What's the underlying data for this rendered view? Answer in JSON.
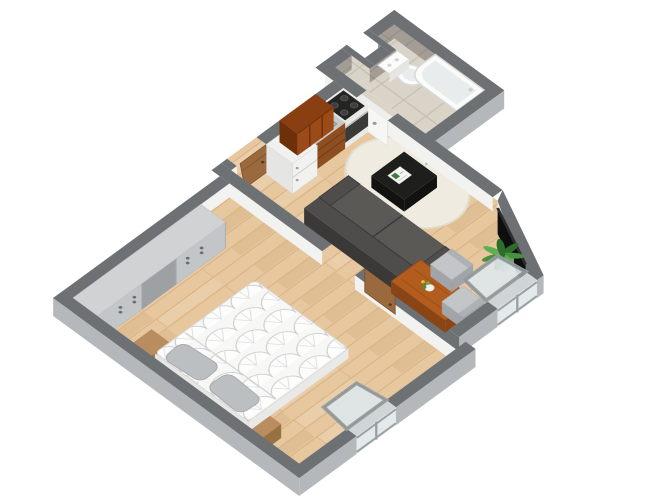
{
  "scene": {
    "description": "3D isometric floor plan render of a one-bedroom apartment, rotated diamond orientation on white background",
    "background": "#ffffff",
    "rooms": [
      {
        "name": "bathroom",
        "floor": "beige-tile",
        "walls": "grey-tile",
        "furniture": [
          "toilet",
          "corner-bathtub"
        ],
        "doors": [
          "bathroom-door-white"
        ]
      },
      {
        "name": "kitchen-living-room",
        "floor": "oak-parquet",
        "furniture": [
          "fridge",
          "kitchen-counter-sink",
          "stove",
          "upper-cabinets",
          "sofa",
          "tv",
          "oval-rug",
          "coffee-table",
          "dining-table",
          "dining-chairs",
          "potted-plant",
          "tilted-open-window"
        ],
        "doors": [
          "entry-door-wood",
          "bathroom-door-white",
          "bedroom-door-wood"
        ]
      },
      {
        "name": "bedroom",
        "floor": "oak-parquet",
        "furniture": [
          "double-bed-patterned-duvet",
          "pillows",
          "nightstands",
          "wardrobe",
          "tilted-open-window"
        ],
        "doors": [
          "bedroom-door-wood"
        ]
      }
    ],
    "palette": {
      "wallTop": "#6e7174",
      "wallExt": "#b5b8ba",
      "wallInt": "#f2f2f0",
      "tileWall": "#a49d96",
      "tileWallLine": "#958e87",
      "floorWood": "#e7c79e",
      "floorLine": "#c89a66",
      "floorTile": "#dad4c8",
      "floorTileLine": "#c7c0b3",
      "rug": "#f0ebe0",
      "rugEdge": "#e2dccd",
      "sofa": "#4e4d4b",
      "sofaSeat": "#5a5956",
      "sofaDark": "#3a3937",
      "coffeeTable": "#1e1e1c",
      "coffeeTableDark": "#121210",
      "tv": "#0e0e0e",
      "tvEdge": "#2e2e2e",
      "diningTable": "#b25c1e",
      "diningTableDark": "#8a4517",
      "chair": "#c3c6c8",
      "chairDark": "#a2a5a7",
      "upperCab": "#8a3f12",
      "upperCabFace": "#9c4b18",
      "upperCabDark": "#6e3009",
      "counter": "#c9c9c7",
      "cabinetFace": "#8f4e22",
      "cabinetDark": "#733c14",
      "stoveTop": "#242422",
      "stoveRim": "#e9e9e7",
      "burner": "#3f3f3d",
      "appliance": "#f1f1ef",
      "applianceFace": "#e5e5e3",
      "applianceLine": "#cfcfcd",
      "sink": "#aeb2b4",
      "sinkInner": "#989c9e",
      "fixture": "#fbfbf9",
      "fixtureShade": "#e9eced",
      "fixtureLine": "#d7dbdc",
      "doorWood": "#9a6a3e",
      "doorWoodDark": "#7e5430",
      "doorWhite": "#f6f6f4",
      "frame": "#9aa0a2",
      "glass": "#dfe7ea",
      "glassWall": "#e4eaec",
      "duvet": "#f7f7f5",
      "duvetLine": "#c9cccf",
      "pillow": "#bcbfc1",
      "pillowLine": "#a8abad",
      "nightstand": "#b98d5f",
      "nightstandDark": "#97713f",
      "wardrobe": "#d0d2d4",
      "wardrobeFace": "#c3c6c8",
      "wardrobePanel": "#9da1a4",
      "handle": "#6b6e71",
      "plant1": "#2f6d2c",
      "plant2": "#47913d",
      "plant3": "#61ad52",
      "pot": "#8d9092",
      "potDark": "#77797b",
      "flowerGreen": "#4e8d3a",
      "flowerWhite": "#f0f0ee"
    }
  }
}
